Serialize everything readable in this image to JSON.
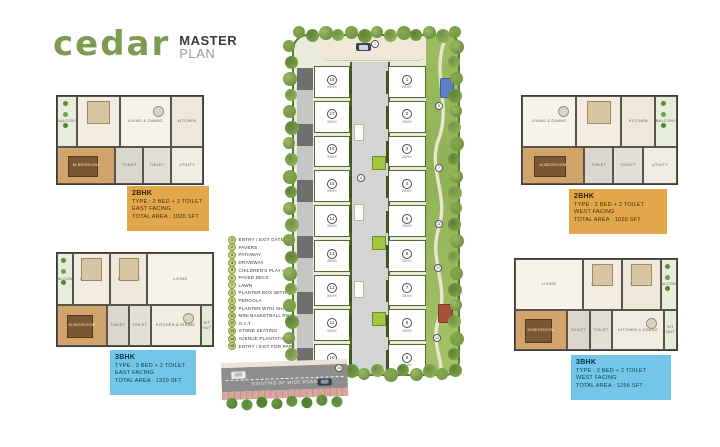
{
  "header": {
    "brand": "cedar",
    "title_top": "MASTER",
    "title_bottom": "PLAN"
  },
  "floorplans": {
    "top_left": {
      "name": "2BHK",
      "type": "TYPE : 2 BED + 2 TOILET",
      "facing": "EAST FACING",
      "area": "TOTAL AREA : 1020 SFT",
      "rooms": [
        "BALCONY",
        "BEDROOM",
        "LIVING & DINING",
        "KITCHEN",
        "M.BEDROOM",
        "TOILET",
        "TOILET",
        "UTILITY"
      ]
    },
    "top_right": {
      "name": "2BHK",
      "type": "TYPE : 2 BED + 2 TOILET",
      "facing": "WEST FACING",
      "area": "TOTAL AREA : 1020 SFT",
      "rooms": [
        "LIVING & DINING",
        "BEDROOM",
        "BALCONY",
        "KITCHEN",
        "M.BEDROOM",
        "TOILET",
        "TOILET",
        "UTILITY"
      ]
    },
    "bottom_left": {
      "name": "3BHK",
      "type": "TYPE : 3 BED + 2 TOILET",
      "facing": "EAST FACING",
      "area": "TOTAL AREA : 1310 SFT",
      "rooms": [
        "BALCONY",
        "BEDROOM",
        "BEDROOM",
        "LIVING",
        "M.BEDROOM",
        "TOILET",
        "TOILET",
        "KITCHEN & DINING",
        "SIT OUT"
      ]
    },
    "bottom_right": {
      "name": "3BHK",
      "type": "TYPE : 3 BED + 2 TOILET",
      "facing": "WEST FACING",
      "area": "TOTAL AREA : 1256 SFT",
      "rooms": [
        "LIVING",
        "BEDROOM",
        "BEDROOM",
        "BALCONY",
        "M.BEDROOM",
        "TOILET",
        "TOILET",
        "KITCHEN & DINING",
        "SIT OUT"
      ]
    }
  },
  "legend": {
    "items": [
      {
        "num": "1",
        "label": "ENTRY / EXIT GATE"
      },
      {
        "num": "2",
        "label": "PAVERS"
      },
      {
        "num": "3",
        "label": "PATHWAY"
      },
      {
        "num": "4",
        "label": "DRIVEWAY"
      },
      {
        "num": "5",
        "label": "CHILDREN'S PLAY AREA"
      },
      {
        "num": "6",
        "label": "PAVED DECK"
      },
      {
        "num": "7",
        "label": "LAWN"
      },
      {
        "num": "8",
        "label": "PLANTER BOX WITH PALM"
      },
      {
        "num": "9",
        "label": "PERGOLA"
      },
      {
        "num": "10",
        "label": "PLANTER WITH SHADE PLANT"
      },
      {
        "num": "11",
        "label": "MINI BASKETBALL RINK"
      },
      {
        "num": "12",
        "label": "O.A.T."
      },
      {
        "num": "13",
        "label": "STONE SEATING"
      },
      {
        "num": "14",
        "label": "AVENUE PLANTATION"
      },
      {
        "num": "15",
        "label": "ENTRY / EXIT FOR PARKING"
      }
    ]
  },
  "siteplan": {
    "road_label": "EXISTING 30' WIDE ROAD",
    "left_units": [
      {
        "num": "18",
        "label": "3BHK"
      },
      {
        "num": "17",
        "label": "3BHK"
      },
      {
        "num": "16",
        "label": "3BHK"
      },
      {
        "num": "15",
        "label": "3BHK"
      },
      {
        "num": "14",
        "label": "3BHK"
      },
      {
        "num": "13",
        "label": "3BHK"
      },
      {
        "num": "12",
        "label": "3BHK"
      },
      {
        "num": "11",
        "label": "3BHK"
      },
      {
        "num": "10",
        "label": "3BHK"
      }
    ],
    "right_units": [
      {
        "num": "1",
        "label": "2BHK"
      },
      {
        "num": "2",
        "label": "2BHK"
      },
      {
        "num": "3",
        "label": "2BHK"
      },
      {
        "num": "4",
        "label": "2BHK"
      },
      {
        "num": "5",
        "label": "2BHK"
      },
      {
        "num": "6",
        "label": "2BHK"
      },
      {
        "num": "7",
        "label": "2BHK"
      },
      {
        "num": "8",
        "label": "2BHK"
      },
      {
        "num": "9",
        "label": "2BHK"
      }
    ],
    "markers": [
      {
        "num": "1",
        "x": 88,
        "y": 16
      },
      {
        "num": "5",
        "x": 152,
        "y": 78
      },
      {
        "num": "4",
        "x": 74,
        "y": 150
      },
      {
        "num": "7",
        "x": 152,
        "y": 140
      },
      {
        "num": "11",
        "x": 152,
        "y": 196
      },
      {
        "num": "12",
        "x": 151,
        "y": 240
      },
      {
        "num": "13",
        "x": 150,
        "y": 310
      },
      {
        "num": "15",
        "x": 52,
        "y": 340
      }
    ]
  },
  "colors": {
    "brand_green": "#7d9c52",
    "label_orange": "#e2a64b",
    "label_blue": "#74c6e8",
    "tree_greens": [
      "#6d923f",
      "#87a94f",
      "#5e8136",
      "#9cbb63"
    ],
    "bush_greens": [
      "#4f7a33",
      "#6a9944",
      "#5c8a3b"
    ]
  }
}
